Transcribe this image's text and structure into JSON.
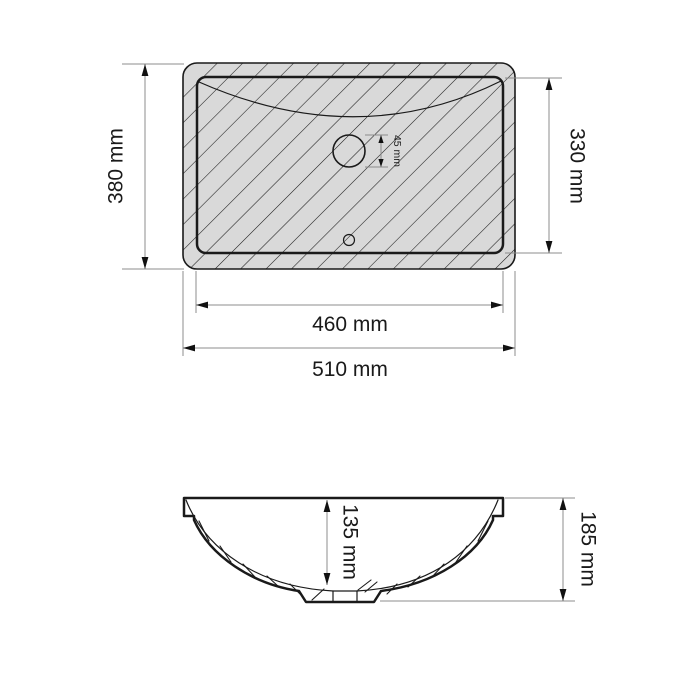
{
  "colors": {
    "line": "#1a1a1a",
    "dim_line": "#8c8c8c",
    "rim_fill": "#d9d9d9",
    "background": "#ffffff"
  },
  "top_view": {
    "outer_height_label": "380 mm",
    "inner_height_label": "330 mm",
    "hole_diameter_label": "45 mm",
    "inner_width_label": "460 mm",
    "outer_width_label": "510 mm"
  },
  "side_view": {
    "bowl_depth_label": "135 mm",
    "overall_height_label": "185 mm"
  }
}
